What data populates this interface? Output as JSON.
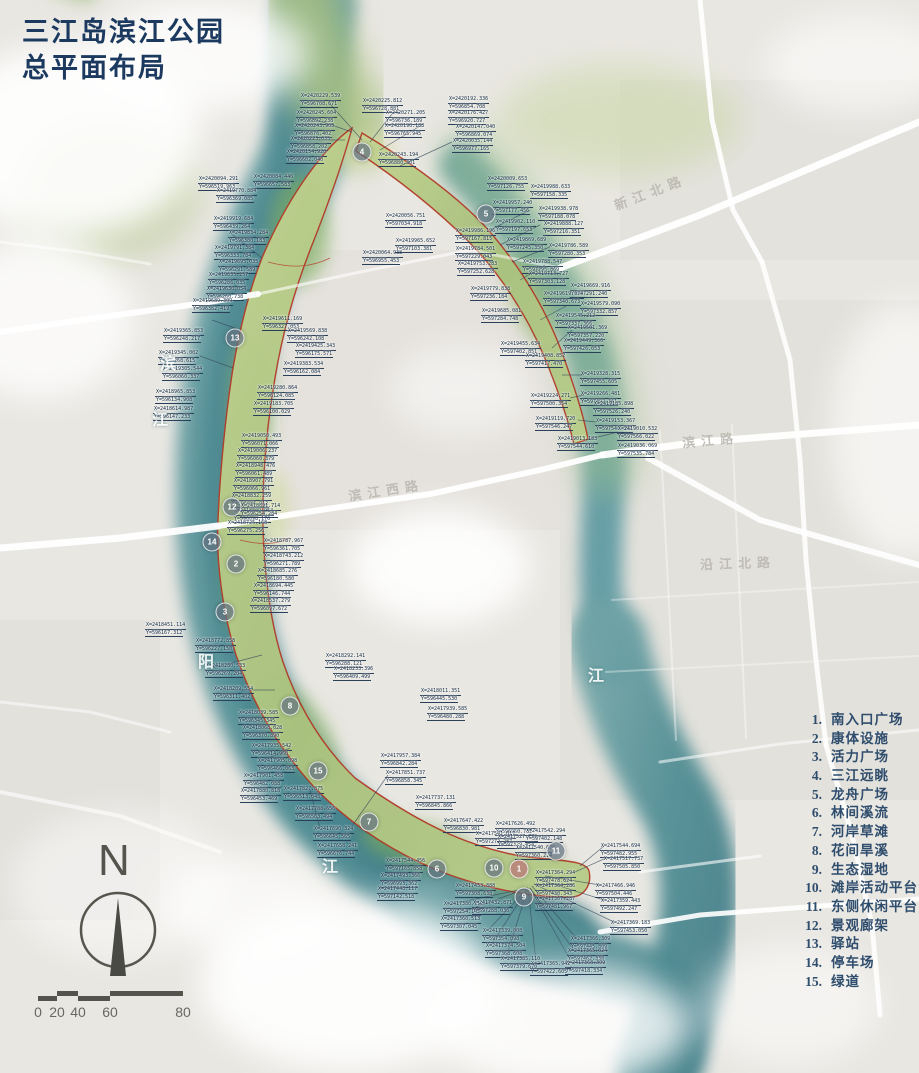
{
  "title": {
    "line1": "三江岛滨江公园",
    "line2": "总平面布局"
  },
  "legend": {
    "items": [
      {
        "num": "1.",
        "label": "南入口广场"
      },
      {
        "num": "2.",
        "label": "康体设施"
      },
      {
        "num": "3.",
        "label": "活力广场"
      },
      {
        "num": "4.",
        "label": "三江远眺"
      },
      {
        "num": "5.",
        "label": "龙舟广场"
      },
      {
        "num": "6.",
        "label": "林间溪流"
      },
      {
        "num": "7.",
        "label": "河岸草滩"
      },
      {
        "num": "8.",
        "label": "花间旱溪"
      },
      {
        "num": "9.",
        "label": "生态湿地"
      },
      {
        "num": "10.",
        "label": "滩岸活动平台"
      },
      {
        "num": "11.",
        "label": "东侧休闲平台"
      },
      {
        "num": "12.",
        "label": "景观廊架"
      },
      {
        "num": "13.",
        "label": "驿站"
      },
      {
        "num": "14.",
        "label": "停车场"
      },
      {
        "num": "15.",
        "label": "绿道"
      }
    ]
  },
  "north": {
    "label": "N"
  },
  "scale_bar": {
    "ticks": [
      "0",
      "20",
      "40",
      "60",
      "80"
    ]
  },
  "colors": {
    "title_navy": "#1c3a5f",
    "legend_navy": "#2f4d6d",
    "boundary_red": "#b23a28",
    "water_teal": "#4f8d94",
    "park_green": "#a9c17f",
    "label_navy": "#152c45"
  },
  "map": {
    "road_labels": [
      {
        "text": "新江北路",
        "x": 612,
        "y": 182,
        "rot": -21
      },
      {
        "text": "滨江路",
        "x": 682,
        "y": 430,
        "rot": -5
      },
      {
        "text": "沿江北路",
        "x": 700,
        "y": 553,
        "rot": -2
      },
      {
        "text": "滨江西路",
        "x": 348,
        "y": 480,
        "rot": -9
      }
    ],
    "river_labels": [
      {
        "text": "滨",
        "x": 160,
        "y": 350
      },
      {
        "text": "江",
        "x": 152,
        "y": 406
      },
      {
        "text": "阳",
        "x": 198,
        "y": 648
      },
      {
        "text": "江",
        "x": 322,
        "y": 853
      },
      {
        "text": "江",
        "x": 588,
        "y": 662
      }
    ],
    "markers": [
      {
        "num": "1",
        "x": 519,
        "y": 869
      },
      {
        "num": "2",
        "x": 236,
        "y": 564
      },
      {
        "num": "3",
        "x": 225,
        "y": 612
      },
      {
        "num": "4",
        "x": 362,
        "y": 152
      },
      {
        "num": "5",
        "x": 486,
        "y": 214
      },
      {
        "num": "6",
        "x": 437,
        "y": 869
      },
      {
        "num": "7",
        "x": 369,
        "y": 822
      },
      {
        "num": "8",
        "x": 290,
        "y": 706
      },
      {
        "num": "9",
        "x": 524,
        "y": 897
      },
      {
        "num": "10",
        "x": 494,
        "y": 868
      },
      {
        "num": "11",
        "x": 556,
        "y": 851
      },
      {
        "num": "12",
        "x": 232,
        "y": 507
      },
      {
        "num": "13",
        "x": 235,
        "y": 338
      },
      {
        "num": "14",
        "x": 212,
        "y": 542
      },
      {
        "num": "15",
        "x": 318,
        "y": 771
      }
    ],
    "coord_labels": [
      [
        300,
        93,
        "X=2420229.539",
        "Y=596708.671"
      ],
      [
        362,
        98,
        "X=2420225.812",
        "Y=596728.881"
      ],
      [
        448,
        96,
        "X=2420192.336",
        "Y=596854.708"
      ],
      [
        296,
        110,
        "X=2420245.604",
        "Y=596892.238"
      ],
      [
        385,
        110,
        "X=2420271.205",
        "Y=596736.189"
      ],
      [
        294,
        123,
        "X=2420243.905",
        "Y=596876.402"
      ],
      [
        448,
        110,
        "X=2420176.427",
        "Y=596920.727"
      ],
      [
        290,
        136,
        "X=2420223.035",
        "Y=596858.202"
      ],
      [
        384,
        123,
        "X=2420190.188",
        "Y=596765.945"
      ],
      [
        455,
        124,
        "X=2420147.040",
        "Y=596869.074"
      ],
      [
        286,
        149,
        "X=2420154.920",
        "Y=596602.040"
      ],
      [
        452,
        138,
        "X=2420035.144",
        "Y=596977.165"
      ],
      [
        378,
        152,
        "X=2420243.194",
        "Y=596880.301"
      ],
      [
        198,
        176,
        "X=2420094.291",
        "Y=596519.963"
      ],
      [
        253,
        174,
        "X=2420084.446",
        "Y=596657.583"
      ],
      [
        362,
        250,
        "X=2420064.938",
        "Y=596955.453"
      ],
      [
        385,
        213,
        "X=2420056.751",
        "Y=597034.918"
      ],
      [
        395,
        238,
        "X=2419965.652",
        "Y=597103.381"
      ],
      [
        487,
        176,
        "X=2420009.653",
        "Y=597126.755"
      ],
      [
        530,
        184,
        "X=2419988.633",
        "Y=597158.335"
      ],
      [
        492,
        200,
        "X=2419957.240",
        "Y=597177.456"
      ],
      [
        538,
        206,
        "X=2419938.978",
        "Y=597188.078"
      ],
      [
        495,
        219,
        "X=2419902.110",
        "Y=597197.653"
      ],
      [
        543,
        221,
        "X=2419888.127",
        "Y=597216.351"
      ],
      [
        506,
        237,
        "X=2419869.689",
        "Y=597245.350"
      ],
      [
        548,
        243,
        "X=2419786.589",
        "Y=597280.353"
      ],
      [
        455,
        228,
        "X=2419986.196",
        "Y=597167.815"
      ],
      [
        522,
        259,
        "X=2419788.547",
        "Y=597295.869"
      ],
      [
        528,
        271,
        "X=2419713.727",
        "Y=597303.128"
      ],
      [
        455,
        246,
        "X=2419784.501",
        "Y=597229.043"
      ],
      [
        457,
        261,
        "X=2419753.283",
        "Y=597252.628"
      ],
      [
        470,
        286,
        "X=2419779.838",
        "Y=597236.184"
      ],
      [
        481,
        308,
        "X=2419685.081",
        "Y=597284.748"
      ],
      [
        570,
        283,
        "X=2419669.916",
        "Y=597291.240"
      ],
      [
        543,
        291,
        "X=2419619.374",
        "Y=597340.673"
      ],
      [
        580,
        301,
        "X=2419579.090",
        "Y=597332.857"
      ],
      [
        555,
        313,
        "X=2419545.212",
        "Y=597337.366"
      ],
      [
        567,
        325,
        "X=2419501.369",
        "Y=597357.220"
      ],
      [
        563,
        338,
        "X=2419449.366",
        "Y=597426.053"
      ],
      [
        500,
        341,
        "X=2419455.634",
        "Y=597402.851"
      ],
      [
        525,
        353,
        "X=2419408.852",
        "Y=597417.470"
      ],
      [
        580,
        371,
        "X=2419328.315",
        "Y=597455.605"
      ],
      [
        580,
        391,
        "X=2419266.481",
        "Y=597492.361"
      ],
      [
        593,
        401,
        "X=2419185.898",
        "Y=597526.240"
      ],
      [
        595,
        418,
        "X=2419153.367",
        "Y=597546.392"
      ],
      [
        530,
        393,
        "X=2419224.271",
        "Y=597500.354"
      ],
      [
        535,
        416,
        "X=2419119.720",
        "Y=597546.247"
      ],
      [
        557,
        436,
        "X=2419013.183",
        "Y=597544.610"
      ],
      [
        617,
        426,
        "X=2419010.532",
        "Y=597566.022"
      ],
      [
        617,
        443,
        "X=2419036.069",
        "Y=597535.784"
      ],
      [
        216,
        188,
        "X=2419770.884",
        "Y=596369.085"
      ],
      [
        213,
        216,
        "X=2419919.684",
        "Y=596439.264"
      ],
      [
        228,
        230,
        "X=2419834.284",
        "Y=596380.183"
      ],
      [
        214,
        245,
        "X=2419791.384",
        "Y=596333.784"
      ],
      [
        218,
        259,
        "X=2419695.035",
        "Y=596291.589"
      ],
      [
        208,
        272,
        "X=2419635.257",
        "Y=596286.035"
      ],
      [
        206,
        286,
        "X=2419630.054",
        "Y=596260.738"
      ],
      [
        192,
        298,
        "X=2419689.309",
        "Y=596382.419"
      ],
      [
        262,
        316,
        "X=2419611.169",
        "Y=596327.053"
      ],
      [
        287,
        328,
        "X=2419569.838",
        "Y=596242.108"
      ],
      [
        295,
        343,
        "X=2419425.343",
        "Y=596175.571"
      ],
      [
        283,
        361,
        "X=2419383.534",
        "Y=596162.084"
      ],
      [
        257,
        385,
        "X=2419280.864",
        "Y=596124.085"
      ],
      [
        253,
        401,
        "X=2419183.705",
        "Y=596100.029"
      ],
      [
        241,
        433,
        "X=2419050.493",
        "Y=596071.066"
      ],
      [
        237,
        448,
        "X=2419006.237",
        "Y=596060.379"
      ],
      [
        235,
        463,
        "X=2418948.476",
        "Y=596061.489"
      ],
      [
        233,
        478,
        "X=2418907.791",
        "Y=596066.961"
      ],
      [
        231,
        493,
        "X=2418832.259",
        "Y=596086.912"
      ],
      [
        233,
        508,
        "X=2418809.954",
        "Y=596098.176"
      ],
      [
        163,
        328,
        "X=2419365.853",
        "Y=596248.217"
      ],
      [
        158,
        350,
        "X=2419345.002",
        "Y=596268.615"
      ],
      [
        162,
        366,
        "X=2419305.544",
        "Y=596060.337"
      ],
      [
        155,
        389,
        "X=2418965.853",
        "Y=596134.908"
      ],
      [
        153,
        406,
        "X=2418614.987",
        "Y=596147.233"
      ],
      [
        240,
        503,
        "X=2418891.714",
        "Y=596254.284"
      ],
      [
        227,
        520,
        "X=2418725.168",
        "Y=596275.256"
      ],
      [
        263,
        538,
        "X=2418787.967",
        "Y=596361.705"
      ],
      [
        263,
        553,
        "X=2418743.212",
        "Y=596271.789"
      ],
      [
        257,
        568,
        "X=2418685.276",
        "Y=596180.580"
      ],
      [
        253,
        583,
        "X=2418694.445",
        "Y=596146.744"
      ],
      [
        250,
        598,
        "X=2418537.279",
        "Y=596097.672"
      ],
      [
        145,
        622,
        "X=2418451.114",
        "Y=596167.312"
      ],
      [
        195,
        638,
        "X=2418772.858",
        "Y=596227.150"
      ],
      [
        205,
        663,
        "X=2418280.533",
        "Y=596269.204"
      ],
      [
        213,
        686,
        "X=2418209.554",
        "Y=596311.402"
      ],
      [
        238,
        710,
        "X=2418039.585",
        "Y=596345.345"
      ],
      [
        242,
        725,
        "X=2418068.028",
        "Y=596370.890"
      ],
      [
        251,
        743,
        "X=2417935.542",
        "Y=596414.960"
      ],
      [
        257,
        758,
        "X=2417905.098",
        "Y=596466.063"
      ],
      [
        243,
        773,
        "X=2417901.458",
        "Y=596482.088"
      ],
      [
        240,
        788,
        "X=2417880.818",
        "Y=596453.469"
      ],
      [
        283,
        786,
        "X=2417827.875",
        "Y=596513.048"
      ],
      [
        295,
        806,
        "X=2417788.656",
        "Y=596563.494"
      ],
      [
        313,
        826,
        "X=2417690.324",
        "Y=596645.565"
      ],
      [
        317,
        843,
        "X=2417658.241",
        "Y=596676.744"
      ],
      [
        325,
        653,
        "X=2418292.141",
        "Y=596288.121"
      ],
      [
        333,
        666,
        "X=2418233.396",
        "Y=596409.499"
      ],
      [
        420,
        688,
        "X=2418011.351",
        "Y=596445.530"
      ],
      [
        427,
        706,
        "X=2417939.585",
        "Y=596480.288"
      ],
      [
        380,
        753,
        "X=2417957.384",
        "Y=596842.284"
      ],
      [
        385,
        770,
        "X=2417851.737",
        "Y=596858.345"
      ],
      [
        415,
        795,
        "X=2417737.131",
        "Y=596845.866"
      ],
      [
        443,
        818,
        "X=2417647.422",
        "Y=596830.981"
      ],
      [
        495,
        821,
        "X=2417626.492",
        "Y=596950.732"
      ],
      [
        475,
        831,
        "X=2417541.017",
        "Y=597272.287"
      ],
      [
        497,
        834,
        "X=2417527.772",
        "Y=597329.454"
      ],
      [
        525,
        828,
        "X=2417542.294",
        "Y=597402.148"
      ],
      [
        515,
        845,
        "X=2417540.678",
        "Y=597360.214"
      ],
      [
        600,
        843,
        "X=2417544.694",
        "Y=597482.955"
      ],
      [
        603,
        856,
        "X=2417517.737",
        "Y=597505.850"
      ],
      [
        595,
        883,
        "X=2417466.946",
        "Y=597504.446"
      ],
      [
        600,
        898,
        "X=2417359.443",
        "Y=597492.247"
      ],
      [
        535,
        870,
        "X=2417364.294",
        "Y=597478.624"
      ],
      [
        535,
        883,
        "X=2417364.286",
        "Y=597430.343"
      ],
      [
        535,
        896,
        "X=2417367.287",
        "Y=597481.967"
      ],
      [
        610,
        920,
        "X=2417369.183",
        "Y=597453.050"
      ],
      [
        570,
        936,
        "X=2417366.309",
        "Y=597445.809"
      ],
      [
        567,
        948,
        "X=2417365.024",
        "Y=597462.338"
      ],
      [
        565,
        960,
        "X=2417368.309",
        "Y=597418.334"
      ],
      [
        530,
        961,
        "X=2417365.942",
        "Y=597422.605"
      ],
      [
        443,
        901,
        "X=2417380.112",
        "Y=597254.142"
      ],
      [
        440,
        916,
        "X=2417360.513",
        "Y=597307.045"
      ],
      [
        482,
        928,
        "X=2417339.008",
        "Y=597354.098"
      ],
      [
        485,
        943,
        "X=2417374.504",
        "Y=597368.608"
      ],
      [
        500,
        956,
        "X=2417385.110",
        "Y=597379.670"
      ],
      [
        385,
        858,
        "X=2417544.456",
        "Y=597165.858"
      ],
      [
        380,
        873,
        "X=2417493.366",
        "Y=596993.362"
      ],
      [
        377,
        886,
        "X=2417448.117",
        "Y=597142.518"
      ],
      [
        455,
        883,
        "X=2417453.888",
        "Y=597308.638"
      ],
      [
        472,
        900,
        "X=2417432.871",
        "Y=597288.036"
      ]
    ]
  }
}
